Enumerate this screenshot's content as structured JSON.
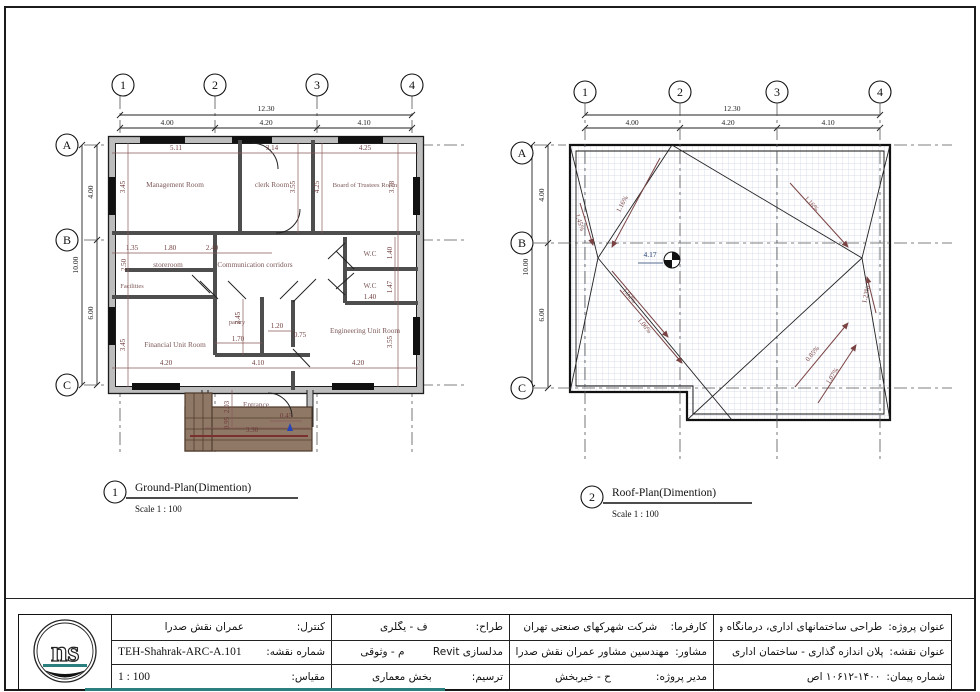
{
  "colors": {
    "dimension_text": "#6e3b3b",
    "room_label": "#7d5858",
    "roof_grid": "#ccd3e4",
    "spot_elevation_blue": "#1f3a6e",
    "stairs_brown": "#8f7866",
    "teal_strip": "#2c7f7f"
  },
  "ground_plan": {
    "callout_number": "1",
    "title": "Ground-Plan(Dimention)",
    "scale_label": "Scale 1 : 100",
    "grid_columns": [
      "1",
      "2",
      "3",
      "4"
    ],
    "grid_rows": [
      "A",
      "B",
      "C"
    ],
    "top_dims": {
      "total": "12.30",
      "spans": [
        "4.00",
        "4.20",
        "4.10"
      ]
    },
    "left_dims": {
      "total": "10.00",
      "spans": [
        "4.00",
        "6.00"
      ]
    },
    "rooms": {
      "management": {
        "label": "Management Room",
        "w": "5.11",
        "h": "3.45"
      },
      "clerk": {
        "label": "clerk Room",
        "w": "3.14",
        "h": "3.55"
      },
      "board": {
        "label": "Board of Trustees Room",
        "w": "4.25",
        "h2": "4.25",
        "h": "3.78"
      },
      "storeroom": {
        "label": "storeroom",
        "d1": "1.35",
        "d2": "1.80",
        "d3": "2.40",
        "h": "2.50"
      },
      "facilities": {
        "label": "Facilities"
      },
      "corridor": {
        "label": "Communication corridors",
        "d1": "1.20",
        "d2": "0.75"
      },
      "wc1": {
        "label": "W.C",
        "h": "1.40"
      },
      "wc2": {
        "label": "W.C",
        "w": "1.40",
        "h": "1.47"
      },
      "pantry": {
        "label": "pantry",
        "w": "1.70",
        "h": "2.45"
      },
      "financial": {
        "label": "Financial Unit Room",
        "w": "4.20",
        "h": "3.45"
      },
      "engineering": {
        "label": "Engineering Unit Room",
        "w": "4.20",
        "h": "3.55"
      },
      "entrance": {
        "label": "Entrance",
        "w": "4.10",
        "d1": "2.03",
        "d2": "0.95",
        "d3": "3.30",
        "d4": "0.45"
      }
    }
  },
  "roof_plan": {
    "callout_number": "2",
    "title": "Roof-Plan(Dimention)",
    "scale_label": "Scale 1 : 100",
    "grid_columns": [
      "1",
      "2",
      "3",
      "4"
    ],
    "grid_rows": [
      "A",
      "B",
      "C"
    ],
    "top_dims": {
      "total": "12.30",
      "spans": [
        "4.00",
        "4.20",
        "4.10"
      ]
    },
    "left_dims": {
      "total": "10.00",
      "spans": [
        "4.00",
        "6.00"
      ]
    },
    "spot_elevation": "4.17",
    "slopes": [
      "1.16%",
      "1.16%",
      "1.45%",
      "1.02%",
      "1.06%",
      "0.85%",
      "1.07%",
      "1.23%"
    ]
  },
  "title_block": {
    "logo_text": "ns",
    "control": {
      "label": "کنترل:",
      "value": "عمران نقش صدرا"
    },
    "sheet_number": {
      "label": "شماره نقشه:",
      "value": "TEH-Shahrak-ARC-A.101"
    },
    "scale": {
      "label": "مقیاس:",
      "value": "1 : 100"
    },
    "designer": {
      "label": "طراح:",
      "value": "ف - یگلری"
    },
    "modeling": {
      "label": "مدلسازی Revit",
      "value": "م - وثوقی"
    },
    "drafting": {
      "label": "ترسیم:",
      "value": "بخش معماری"
    },
    "client": {
      "label": "کارفرما:",
      "value": "شرکت شهرکهای صنعتی تهران"
    },
    "consultant": {
      "label": "مشاور:",
      "value": "مهندسین مشاور عمران نقش صدرا"
    },
    "project_manager": {
      "label": "مدیر پروژه:",
      "value": "ح - خیربخش"
    },
    "project_title": {
      "label": "عنوان پروژه:",
      "value": "طراحی ساختمانهای اداری، درمانگاه و مسجد"
    },
    "sheet_title": {
      "label": "عنوان نقشه:",
      "value": "پلان اندازه گذاری - ساختمان اداری"
    },
    "contract_number": {
      "label": "شماره پیمان:",
      "value": "۱۰۶۱۲-۱۴۰۰ اص"
    }
  }
}
